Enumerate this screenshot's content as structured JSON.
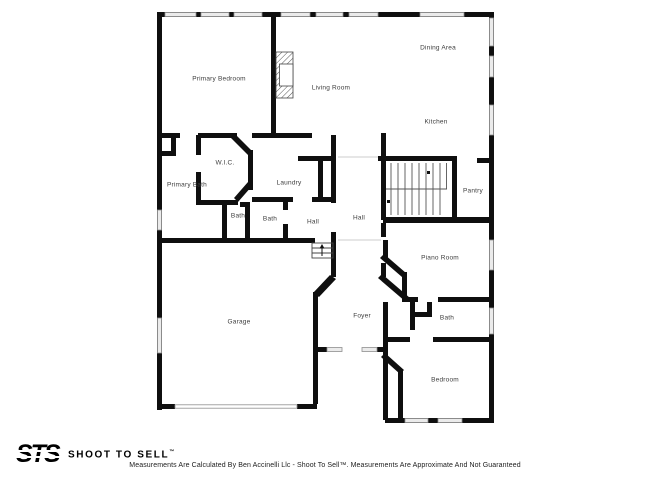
{
  "rooms": [
    {
      "label": "Primary Bedroom"
    },
    {
      "label": "Living Room"
    },
    {
      "label": "Dining Area"
    },
    {
      "label": "Kitchen"
    },
    {
      "label": "W.I.C."
    },
    {
      "label": "Primary Bath"
    },
    {
      "label": "Laundry"
    },
    {
      "label": "Bath"
    },
    {
      "label": "Bath"
    },
    {
      "label": "Hall"
    },
    {
      "label": "Hall"
    },
    {
      "label": "Pantry"
    },
    {
      "label": "Piano Room"
    },
    {
      "label": "Foyer"
    },
    {
      "label": "Bath"
    },
    {
      "label": "Garage"
    },
    {
      "label": "Bedroom"
    }
  ],
  "footer": {
    "logo_text": "STS",
    "brand": "SHOOT TO SELL",
    "brand_tm": "™",
    "disclaimer": "Measurements Are Calculated By Ben Accinelli Llc - Shoot To Sell™. Measurements Are Approximate And Not Guaranteed"
  },
  "colors": {
    "wall": "#0f0f0f",
    "window_fill": "#ebebeb",
    "window_border": "#8f8f8f",
    "label_text": "#3d3d3d",
    "background": "#ffffff"
  }
}
